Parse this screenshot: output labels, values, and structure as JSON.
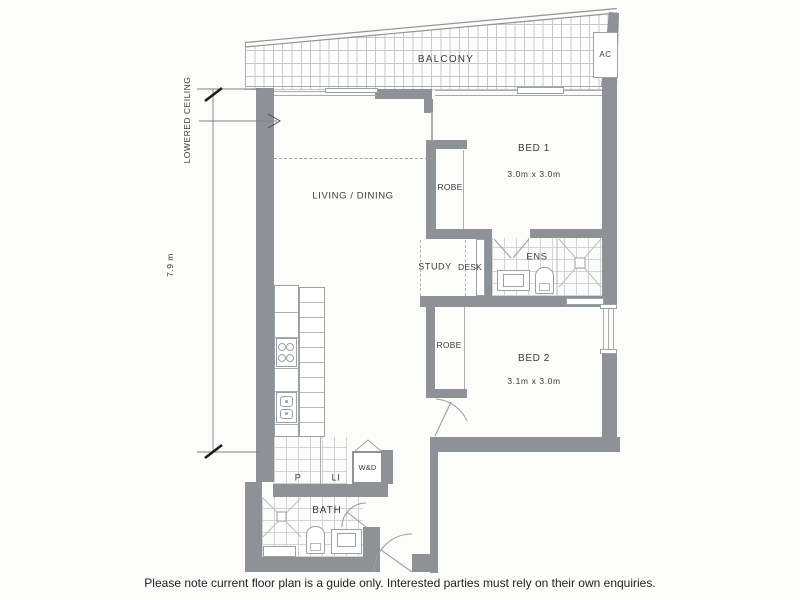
{
  "plan": {
    "balcony": {
      "label": "BALCONY",
      "ac_label": "AC"
    },
    "annotations": {
      "lowered_ceiling": "LOWERED CEILING",
      "height_dimension": "7.9 m"
    },
    "rooms": {
      "living": {
        "label": "LIVING / DINING"
      },
      "bed1": {
        "label": "BED 1",
        "size": "3.0m x 3.0m",
        "robe": "ROBE"
      },
      "study": {
        "label": "STUDY",
        "desk": "DESK"
      },
      "ens": {
        "label": "ENS"
      },
      "bed2": {
        "label": "BED 2",
        "size": "3.1m x 3.0m",
        "robe": "ROBE"
      },
      "laundry": {
        "pantry": "P",
        "linen": "LI",
        "washer_dryer": "W&D"
      },
      "bath": {
        "label": "BATH"
      }
    },
    "colors": {
      "wall": "#8e9296",
      "thin_line": "#a9adb0",
      "tile_line": "#d2d4d6",
      "text": "#3b3b3b",
      "background": "#fcfcfb"
    }
  },
  "footer": {
    "disclaimer": "Please note current floor plan is a guide only. Interested parties must rely on their own enquiries."
  }
}
